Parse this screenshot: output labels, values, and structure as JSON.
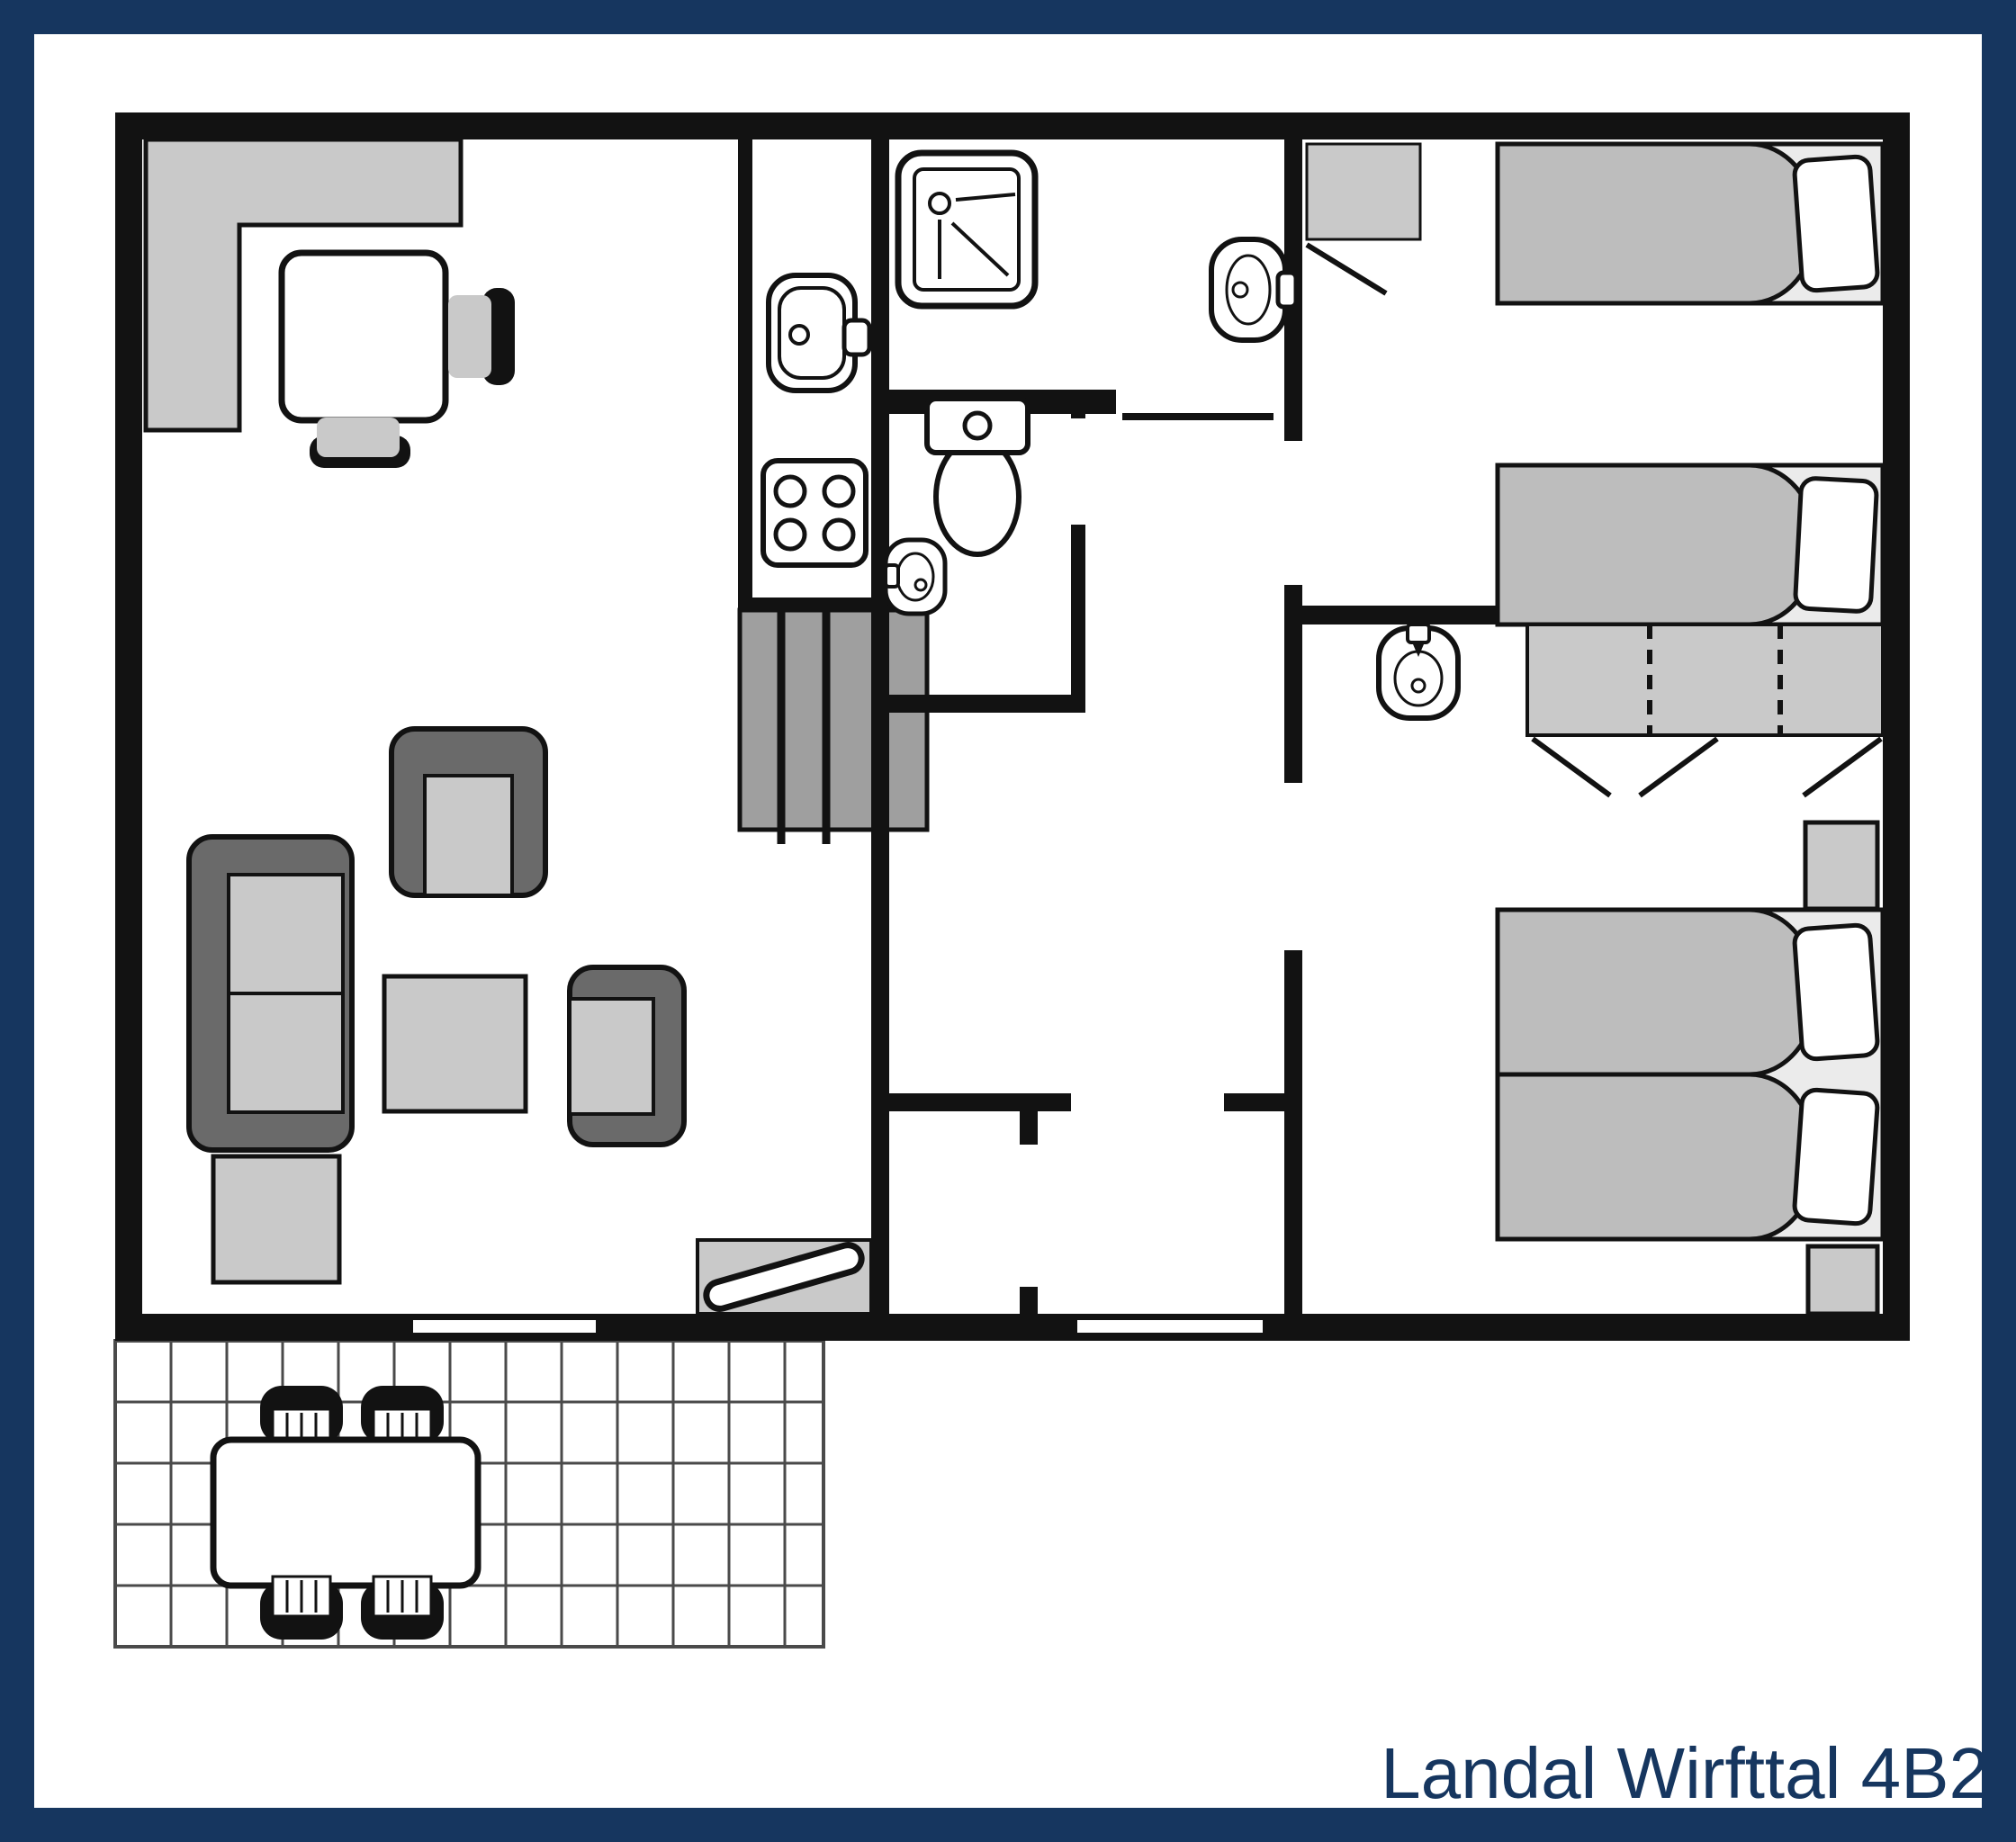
{
  "title": "Landal Wirfttal 4B2",
  "colors": {
    "frame": "#16365f",
    "label": "#16365f",
    "wall": "#121212",
    "gray": "#c9c9c9",
    "dark": "#6a6a6a",
    "duvet": "#bdbdbd",
    "base": "#ebebeb",
    "stairs": "#9f9f9f",
    "grid": "#4a4a4a",
    "white": "#ffffff"
  },
  "fixtures": [
    "corner-bench",
    "dining-table",
    "dining-chair",
    "sofa",
    "armchair",
    "coffee-table",
    "side-table",
    "entrance-door",
    "staircase",
    "kitchen-sink",
    "stove",
    "shower",
    "washbasin",
    "toilet",
    "closet",
    "wardrobe",
    "nightstand",
    "single-bed",
    "double-bed",
    "terrace-tiles",
    "terrace-table",
    "terrace-chair",
    "window",
    "door-opening"
  ]
}
